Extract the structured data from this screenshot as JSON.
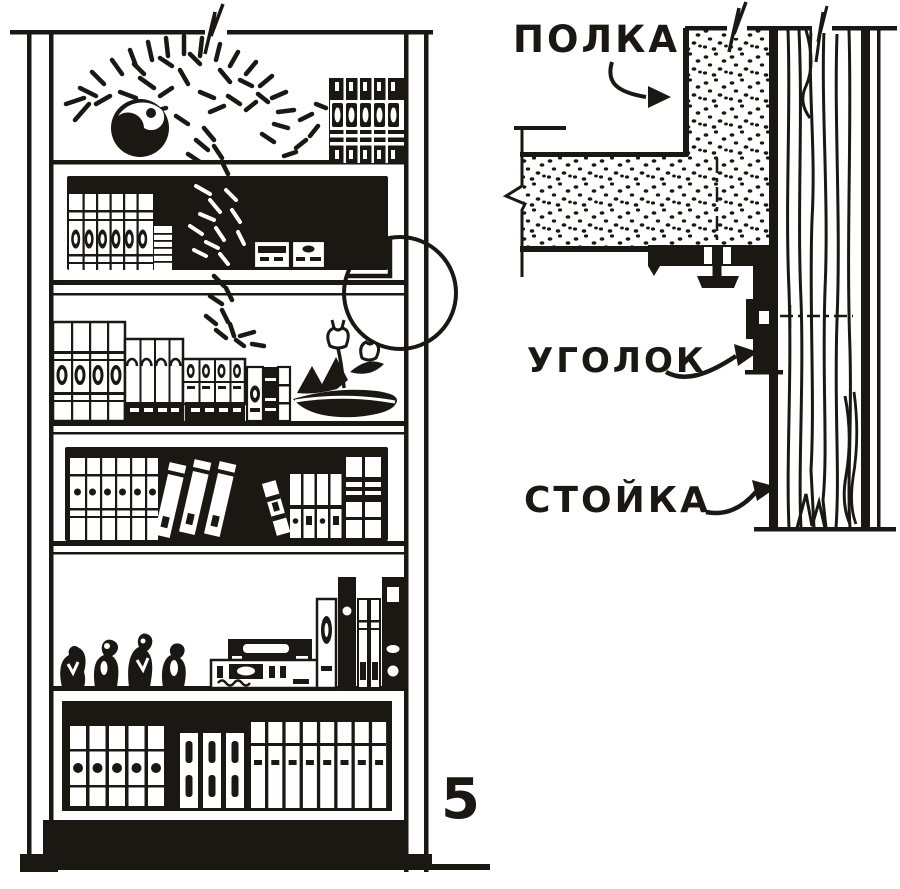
{
  "figure": {
    "number": "5"
  },
  "colors": {
    "ink": "#1b1713",
    "paper": "#ffffff"
  },
  "detail_view": {
    "labels": {
      "shelf": "ПОЛКА",
      "bracket": "УГОЛОК",
      "upright": "СТОЙКА"
    }
  }
}
